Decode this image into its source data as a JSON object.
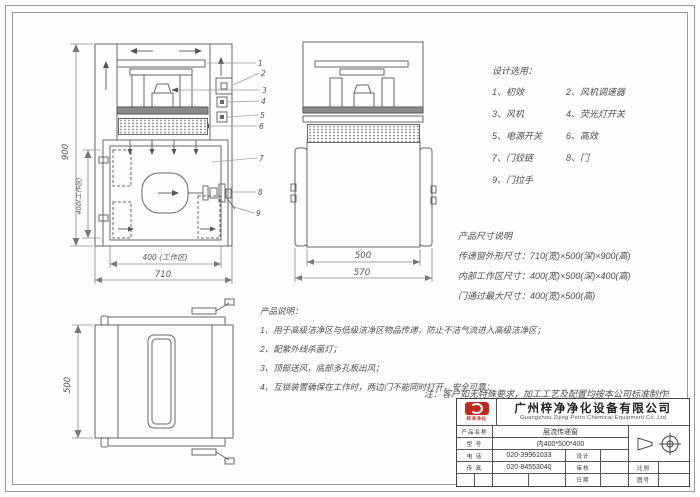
{
  "design": {
    "title": "设计选用：",
    "items": [
      "1、初效",
      "2、风机调速器",
      "3、风机",
      "4、荧光灯开关",
      "5、电源开关",
      "6、高效",
      "7、门铰链",
      "8、门",
      "9、门拉手"
    ]
  },
  "sizes": {
    "title": "产品尺寸说明",
    "lines": [
      "传递窗外形尺寸：710(宽)×500(深)×900(高)",
      "内部工作区尺寸：400(宽)×500(深)×400(高)",
      "门通过最大尺寸：400(宽)×500(高)"
    ]
  },
  "notes": {
    "title": "产品说明：",
    "lines": [
      "1、用于高级洁净区与低级洁净区物品传递，防止不洁气流进入高级洁净区；",
      "2、配紫外线杀菌灯；",
      "3、顶部送风，底部多孔板出风；",
      "4、互锁装置确保在工作时，两边门不能同时打开，安全可靠；"
    ]
  },
  "footnote": "注：客户如无特殊要求，加工工艺及配置均按本公司标准制作!",
  "dims": {
    "front_height": "900",
    "front_inner_height": "400(工作区)",
    "front_inner_width": "400 (工作区)",
    "front_width": "710",
    "side_inner": "500",
    "side_outer": "570",
    "bottom_depth": "500"
  },
  "callouts": [
    "1",
    "2",
    "3",
    "4",
    "5",
    "6",
    "7",
    "8",
    "9"
  ],
  "title_block": {
    "company_cn": "广州梓净净化设备有限公司",
    "company_en": "Guangzhou Zijing Petro Chemical Equipment Co.,Ltd",
    "logo_caption": "梓净净化",
    "product_label": "产品名称",
    "product_value": "层流传递窗",
    "model_label": "型 号",
    "model_value": "内400*500*400",
    "phone1_label": "电 话",
    "phone1_value": "020-39961033",
    "phone2_label": "传 真",
    "phone2_value": "020-84553040",
    "design_label": "设计",
    "check_label": "审核",
    "date_label": "日期",
    "scale_label": "比例",
    "drawno_label": "图号"
  },
  "colors": {
    "line": "#6a6a6a",
    "text": "#4a4a4a",
    "accent_red": "#c2281e"
  }
}
